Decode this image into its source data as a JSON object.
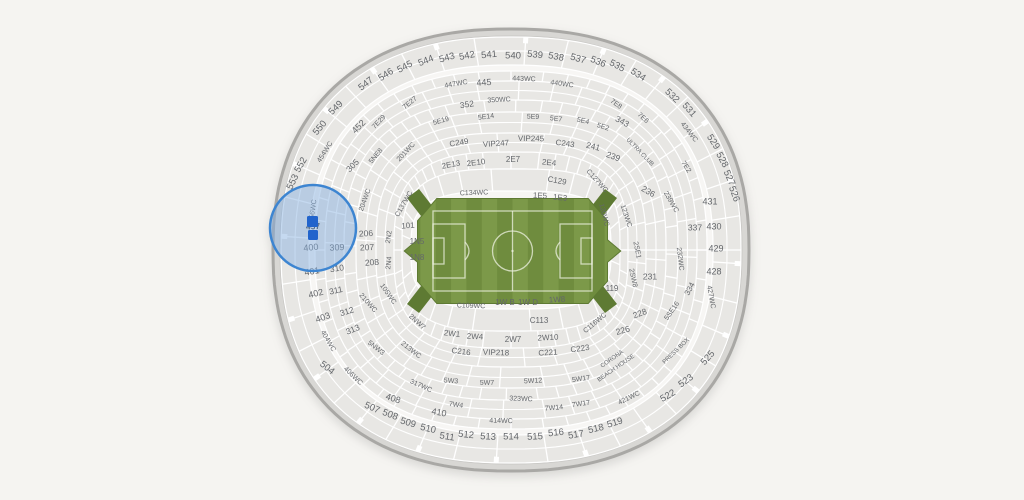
{
  "page": {
    "background": "#f5f4f1"
  },
  "map": {
    "title": "stadium-seat-map",
    "center": {
      "x": 511,
      "y": 250
    },
    "colors": {
      "rim_fill": "#d8d7d4",
      "rim_stroke": "#a9a8a5",
      "interior_fill": "#f7f6f4",
      "interior_stroke": "#c9c8c5",
      "band_fill": "#e8e7e4",
      "divider": "#ffffff",
      "label": "#64676b",
      "field_border": "#5e7a33",
      "field_stripe_dark": "#6f8c3e",
      "field_stripe_light": "#7c9949",
      "field_lines": "rgba(238,242,226,0.75)",
      "highlight_fill": "rgba(134,175,223,0.48)",
      "highlight_stroke": "#3d85d1",
      "marker_fill": "#2264cc"
    },
    "rim": {
      "rx": 238,
      "ry": 221,
      "n": 2.3
    },
    "interior": {
      "rx": 231,
      "ry": 214,
      "n": 2.32
    },
    "bands": [
      {
        "ro": [
          230,
          213
        ],
        "ri": [
          202,
          185
        ],
        "n": 2.35,
        "div": 40,
        "off": 0.04,
        "ticks": true,
        "subarc": 0.5
      },
      {
        "ro": [
          196,
          179
        ],
        "ri": [
          186,
          169
        ],
        "n": 2.45,
        "div": 56,
        "off": 0.0,
        "ticks": false
      },
      {
        "ro": [
          186,
          169
        ],
        "ri": [
          167,
          150
        ],
        "n": 2.5,
        "div": 44,
        "off": 0.02,
        "ticks": false,
        "subarc": 0.5
      },
      {
        "ro": [
          167,
          150
        ],
        "ri": [
          155,
          138
        ],
        "n": 2.6,
        "div": 60,
        "off": 0.01,
        "ticks": false
      },
      {
        "ro": [
          155,
          138
        ],
        "ri": [
          135,
          117
        ],
        "n": 2.7,
        "div": 40,
        "off": 0.03,
        "ticks": false,
        "subarc": 0.5
      },
      {
        "ro": [
          135,
          117
        ],
        "ri": [
          117,
          98
        ],
        "n": 2.8,
        "div": 34,
        "off": 0.05,
        "ticks": false,
        "subarc": 0.5
      },
      {
        "ro": [
          117,
          98
        ],
        "ri": [
          109,
          81
        ],
        "n": 3.0,
        "div": 52,
        "off": 0.0,
        "ticks": false
      },
      {
        "ro": [
          109,
          81
        ],
        "ri": [
          100,
          59
        ],
        "n": 3.3,
        "div": 26,
        "off": 0.06,
        "ticks": false
      }
    ],
    "field": {
      "x1": 418,
      "x2": 607,
      "y1": 199,
      "y2": 303,
      "bevel_x": 19,
      "bevel_y": 22,
      "point_len": 13,
      "point_half": 11,
      "stripes": 14,
      "boundary": {
        "x1": 433,
        "y1": 211,
        "x2": 592,
        "y2": 291
      },
      "circle_r": 20,
      "penalty_w": 32,
      "penalty_h": 54,
      "goal_w": 11,
      "goal_h": 26,
      "arms": [
        [
          [
            433,
            207
          ],
          [
            419,
            189
          ],
          [
            407,
            198
          ],
          [
            421,
            216
          ]
        ],
        [
          [
            591,
            207
          ],
          [
            605,
            189
          ],
          [
            617,
            198
          ],
          [
            603,
            216
          ]
        ],
        [
          [
            433,
            295
          ],
          [
            419,
            313
          ],
          [
            407,
            304
          ],
          [
            421,
            286
          ]
        ],
        [
          [
            591,
            295
          ],
          [
            605,
            313
          ],
          [
            617,
            304
          ],
          [
            603,
            286
          ]
        ]
      ]
    },
    "labels": [
      [
        "547",
        366,
        84,
        -38,
        9.5
      ],
      [
        "546",
        386,
        75,
        -33,
        9.5
      ],
      [
        "545",
        405,
        67,
        -28,
        9.5
      ],
      [
        "544",
        426,
        61,
        -22,
        9.5
      ],
      [
        "543",
        447,
        58,
        -16,
        9.5
      ],
      [
        "542",
        467,
        56,
        -11,
        9.5
      ],
      [
        "541",
        489,
        55,
        -5,
        9.5
      ],
      [
        "540",
        513,
        56,
        1,
        9.5
      ],
      [
        "539",
        535,
        55,
        6,
        9.5
      ],
      [
        "538",
        556,
        57,
        11,
        9.5
      ],
      [
        "537",
        578,
        59,
        16,
        9.5
      ],
      [
        "536",
        598,
        62,
        22,
        9.5
      ],
      [
        "535",
        617,
        66,
        27,
        9.5
      ],
      [
        "534",
        638,
        75,
        33,
        9.5
      ],
      [
        "532",
        672,
        96,
        44,
        9.5
      ],
      [
        "531",
        689,
        110,
        49,
        9.5
      ],
      [
        "529",
        713,
        142,
        57,
        9.5
      ],
      [
        "528",
        722,
        160,
        62,
        9.5
      ],
      [
        "527",
        729,
        178,
        66,
        9.5
      ],
      [
        "526",
        734,
        194,
        70,
        9.5
      ],
      [
        "549",
        336,
        108,
        -44,
        9.5
      ],
      [
        "550",
        320,
        128,
        -50,
        9.5
      ],
      [
        "552",
        301,
        165,
        -60,
        9.5
      ],
      [
        "553",
        293,
        182,
        -64,
        9.5
      ],
      [
        "525",
        708,
        358,
        -48,
        9.5
      ],
      [
        "523",
        686,
        381,
        -36,
        9.5
      ],
      [
        "522",
        668,
        396,
        -30,
        9.5
      ],
      [
        "519",
        615,
        423,
        -17,
        9.5
      ],
      [
        "518",
        596,
        429,
        -13,
        9.5
      ],
      [
        "517",
        576,
        435,
        -9,
        9.5
      ],
      [
        "516",
        556,
        433,
        -6,
        9.5
      ],
      [
        "515",
        535,
        437,
        -3,
        9.5
      ],
      [
        "514",
        511,
        437,
        0,
        9.5
      ],
      [
        "513",
        488,
        437,
        3,
        9.5
      ],
      [
        "512",
        466,
        435,
        6,
        9.5
      ],
      [
        "511",
        447,
        437,
        9,
        9.5
      ],
      [
        "510",
        428,
        429,
        13,
        9.5
      ],
      [
        "509",
        408,
        423,
        17,
        9.5
      ],
      [
        "508",
        390,
        415,
        21,
        9.5
      ],
      [
        "507",
        372,
        408,
        24,
        9.5
      ],
      [
        "504",
        327,
        368,
        38,
        9.5
      ],
      [
        "452",
        359,
        127,
        -45,
        9
      ],
      [
        "454WC",
        325,
        152,
        -58,
        7
      ],
      [
        "456WC",
        313,
        211,
        -82,
        7
      ],
      [
        "400",
        311,
        248,
        -6,
        9
      ],
      [
        "309",
        337,
        248,
        -3,
        9
      ],
      [
        "401",
        312,
        272,
        -10,
        9
      ],
      [
        "402",
        316,
        294,
        -14,
        9
      ],
      [
        "403",
        323,
        318,
        -20,
        9
      ],
      [
        "404WC",
        328,
        341,
        60,
        7
      ],
      [
        "406WC",
        353,
        376,
        44,
        7
      ],
      [
        "408",
        393,
        399,
        18,
        9
      ],
      [
        "410",
        439,
        413,
        10,
        9
      ],
      [
        "414WC",
        501,
        421,
        1,
        7
      ],
      [
        "421WC",
        629,
        398,
        -26,
        7
      ],
      [
        "427WC",
        711,
        297,
        80,
        7
      ],
      [
        "434WC",
        689,
        132,
        52,
        7
      ],
      [
        "431",
        710,
        202,
        0,
        9
      ],
      [
        "430",
        714,
        227,
        0,
        9
      ],
      [
        "429",
        716,
        249,
        0,
        9
      ],
      [
        "428",
        714,
        272,
        0,
        9
      ],
      [
        "445",
        484,
        83,
        -4,
        9
      ],
      [
        "447WC",
        456,
        84,
        -10,
        7
      ],
      [
        "443WC",
        524,
        79,
        2,
        7
      ],
      [
        "440WC",
        562,
        84,
        8,
        7
      ],
      [
        "305",
        353,
        166,
        -45,
        8.5
      ],
      [
        "310",
        337,
        269,
        -8,
        8.5
      ],
      [
        "311",
        336,
        291,
        -12,
        8.5
      ],
      [
        "312",
        347,
        312,
        -17,
        8.5
      ],
      [
        "313",
        353,
        330,
        -22,
        8.5
      ],
      [
        "317WC",
        421,
        386,
        24,
        7
      ],
      [
        "323WC",
        521,
        399,
        2,
        7
      ],
      [
        "334",
        690,
        289,
        -62,
        8
      ],
      [
        "337",
        695,
        228,
        0,
        8.5
      ],
      [
        "343",
        622,
        122,
        28,
        8.5
      ],
      [
        "350WC",
        499,
        100,
        -3,
        7
      ],
      [
        "352",
        467,
        105,
        -8,
        8.5
      ],
      [
        "7E27",
        410,
        103,
        -40,
        7
      ],
      [
        "7E29",
        379,
        122,
        -47,
        7
      ],
      [
        "7E8",
        616,
        104,
        36,
        7
      ],
      [
        "7E6",
        643,
        118,
        43,
        7
      ],
      [
        "7E2",
        686,
        167,
        57,
        7
      ],
      [
        "5NE8",
        376,
        156,
        -50,
        7
      ],
      [
        "201WC",
        406,
        152,
        -47,
        7
      ],
      [
        "204WC",
        365,
        200,
        -70,
        7
      ],
      [
        "5NW3",
        376,
        348,
        38,
        7
      ],
      [
        "213WC",
        411,
        350,
        38,
        7
      ],
      [
        "210WC",
        368,
        303,
        48,
        7
      ],
      [
        "2NW7",
        417,
        322,
        42,
        7
      ],
      [
        "5W3",
        451,
        381,
        4,
        7
      ],
      [
        "5W7",
        487,
        383,
        1,
        7
      ],
      [
        "5W12",
        533,
        381,
        -3,
        7
      ],
      [
        "5W17",
        581,
        379,
        -8,
        7
      ],
      [
        "7W4",
        456,
        405,
        8,
        7
      ],
      [
        "7W14",
        554,
        408,
        -5,
        7
      ],
      [
        "7W17",
        581,
        404,
        -8,
        7
      ],
      [
        "5SE16",
        672,
        311,
        -55,
        7
      ],
      [
        "5E19",
        441,
        121,
        -16,
        7
      ],
      [
        "5E14",
        486,
        117,
        -7,
        7
      ],
      [
        "5E9",
        533,
        117,
        2,
        7
      ],
      [
        "5E7",
        556,
        119,
        7,
        7
      ],
      [
        "5E4",
        583,
        121,
        13,
        7
      ],
      [
        "5E2",
        603,
        127,
        18,
        7
      ],
      [
        "ULTRA CLUB",
        640,
        152,
        46,
        6
      ],
      [
        "PRESS BOX",
        676,
        351,
        -44,
        6
      ],
      [
        "CORONA",
        612,
        359,
        -35,
        6
      ],
      [
        "BEACH HOUSE",
        616,
        368,
        -35,
        6
      ],
      [
        "C249",
        459,
        143,
        -9,
        8
      ],
      [
        "VIP247",
        496,
        144,
        -4,
        8
      ],
      [
        "VIP245",
        531,
        139,
        1,
        8
      ],
      [
        "C243",
        565,
        144,
        8,
        8
      ],
      [
        "241",
        593,
        147,
        14,
        8.5
      ],
      [
        "239",
        613,
        157,
        20,
        8.5
      ],
      [
        "236",
        648,
        192,
        30,
        8.5
      ],
      [
        "239WC",
        671,
        202,
        60,
        7
      ],
      [
        "2E13",
        451,
        165,
        -11,
        8
      ],
      [
        "2E10",
        476,
        163,
        -7,
        8
      ],
      [
        "2E7",
        513,
        160,
        0,
        8
      ],
      [
        "2E4",
        549,
        163,
        6,
        8
      ],
      [
        "232WC",
        680,
        259,
        83,
        7
      ],
      [
        "231",
        650,
        277,
        0,
        8.5
      ],
      [
        "2SE1",
        637,
        250,
        78,
        7
      ],
      [
        "2SW8",
        633,
        278,
        78,
        7
      ],
      [
        "228",
        640,
        314,
        -20,
        8.5
      ],
      [
        "226",
        623,
        331,
        -15,
        8.5
      ],
      [
        "C223",
        580,
        349,
        -8,
        8
      ],
      [
        "C221",
        548,
        353,
        -3,
        8
      ],
      [
        "VIP218",
        496,
        353,
        2,
        8
      ],
      [
        "C216",
        461,
        352,
        7,
        8
      ],
      [
        "2W1",
        452,
        334,
        6,
        8
      ],
      [
        "2W4",
        475,
        337,
        3,
        8
      ],
      [
        "2W7",
        513,
        340,
        0,
        8
      ],
      [
        "2W10",
        548,
        338,
        -3,
        8
      ],
      [
        "206",
        366,
        234,
        -3,
        8.5
      ],
      [
        "207",
        367,
        248,
        -2,
        8.5
      ],
      [
        "208",
        372,
        263,
        -4,
        8.5
      ],
      [
        "2N2",
        389,
        237,
        -82,
        7
      ],
      [
        "2N4",
        389,
        263,
        -84,
        7
      ],
      [
        "C137WC",
        404,
        204,
        -60,
        7
      ],
      [
        "C134WC",
        474,
        193,
        -2,
        7
      ],
      [
        "1E5",
        540,
        196,
        3,
        8
      ],
      [
        "1E3",
        560,
        198,
        6,
        8
      ],
      [
        "C127WC",
        597,
        181,
        48,
        7
      ],
      [
        "C129",
        557,
        181,
        10,
        8
      ],
      [
        "101",
        408,
        226,
        -4,
        8
      ],
      [
        "1N5",
        417,
        242,
        0,
        8
      ],
      [
        "1N8",
        417,
        258,
        0,
        8
      ],
      [
        "105WC",
        388,
        294,
        55,
        7
      ],
      [
        "C109WC",
        471,
        306,
        2,
        7
      ],
      [
        "1W B",
        505,
        303,
        0,
        8
      ],
      [
        "1W D",
        528,
        303,
        0,
        8
      ],
      [
        "1W8",
        557,
        300,
        -3,
        8
      ],
      [
        "C113",
        539,
        321,
        0,
        8
      ],
      [
        "C116WC",
        595,
        323,
        -40,
        7
      ],
      [
        "119",
        612,
        289,
        0,
        8
      ],
      [
        "123WC",
        626,
        216,
        72,
        7
      ],
      [
        "120WC",
        604,
        215,
        75,
        7
      ]
    ],
    "highlight": {
      "cx": 313,
      "cy": 228,
      "r": 43,
      "selected_section": "457",
      "selected_label": [
        "457",
        313,
        227,
        -3,
        8.5
      ],
      "markers": [
        {
          "x": 307,
          "y": 216,
          "w": 11,
          "h": 11
        },
        {
          "x": 308,
          "y": 230,
          "w": 10,
          "h": 10
        }
      ]
    }
  }
}
